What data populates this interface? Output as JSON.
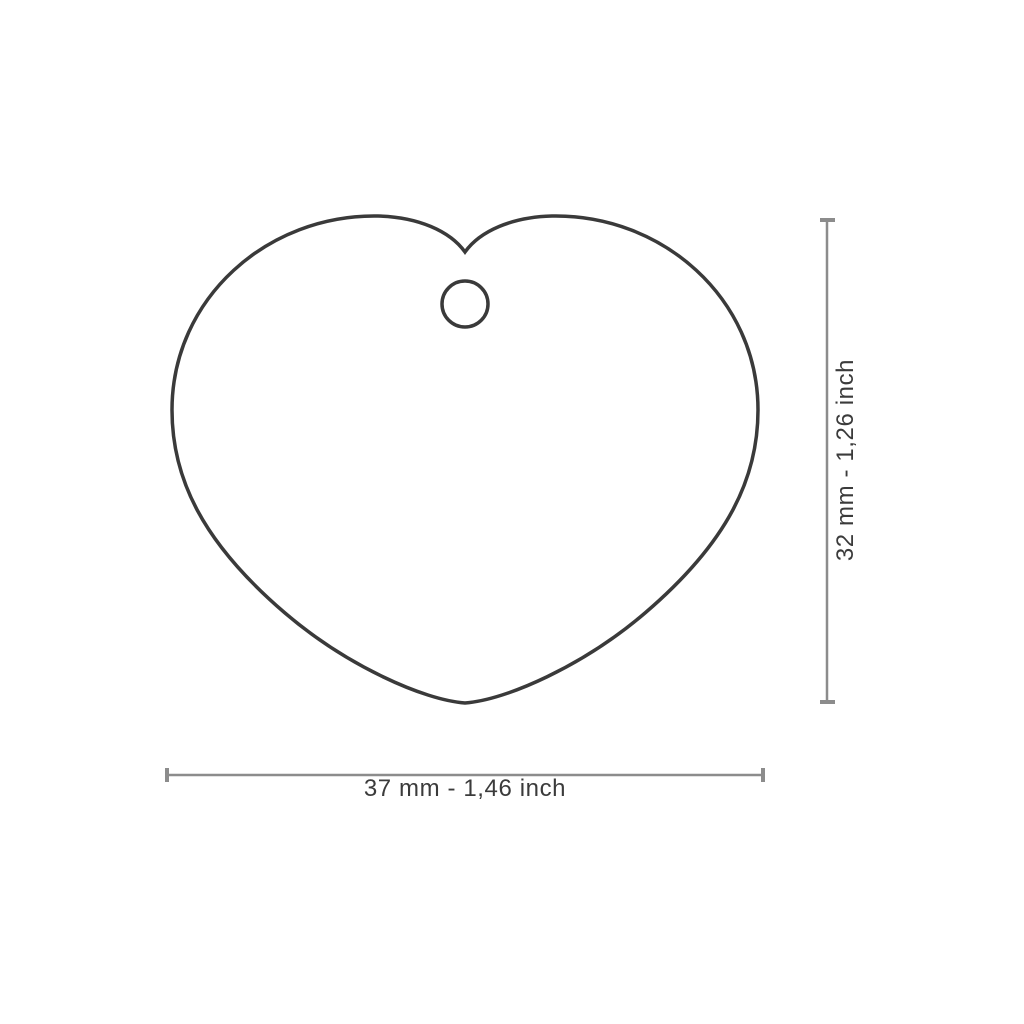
{
  "diagram": {
    "title": "heart tag size diagram",
    "shape": "heart-with-hang-hole",
    "width_label": "37 mm - 1,46 inch",
    "height_label": "32 mm - 1,26 inch",
    "outline_color": "#3a3a3a",
    "dimension_line_color": "#8c8c8c",
    "text_color": "#3b3b3b",
    "background_color": "#ffffff"
  }
}
